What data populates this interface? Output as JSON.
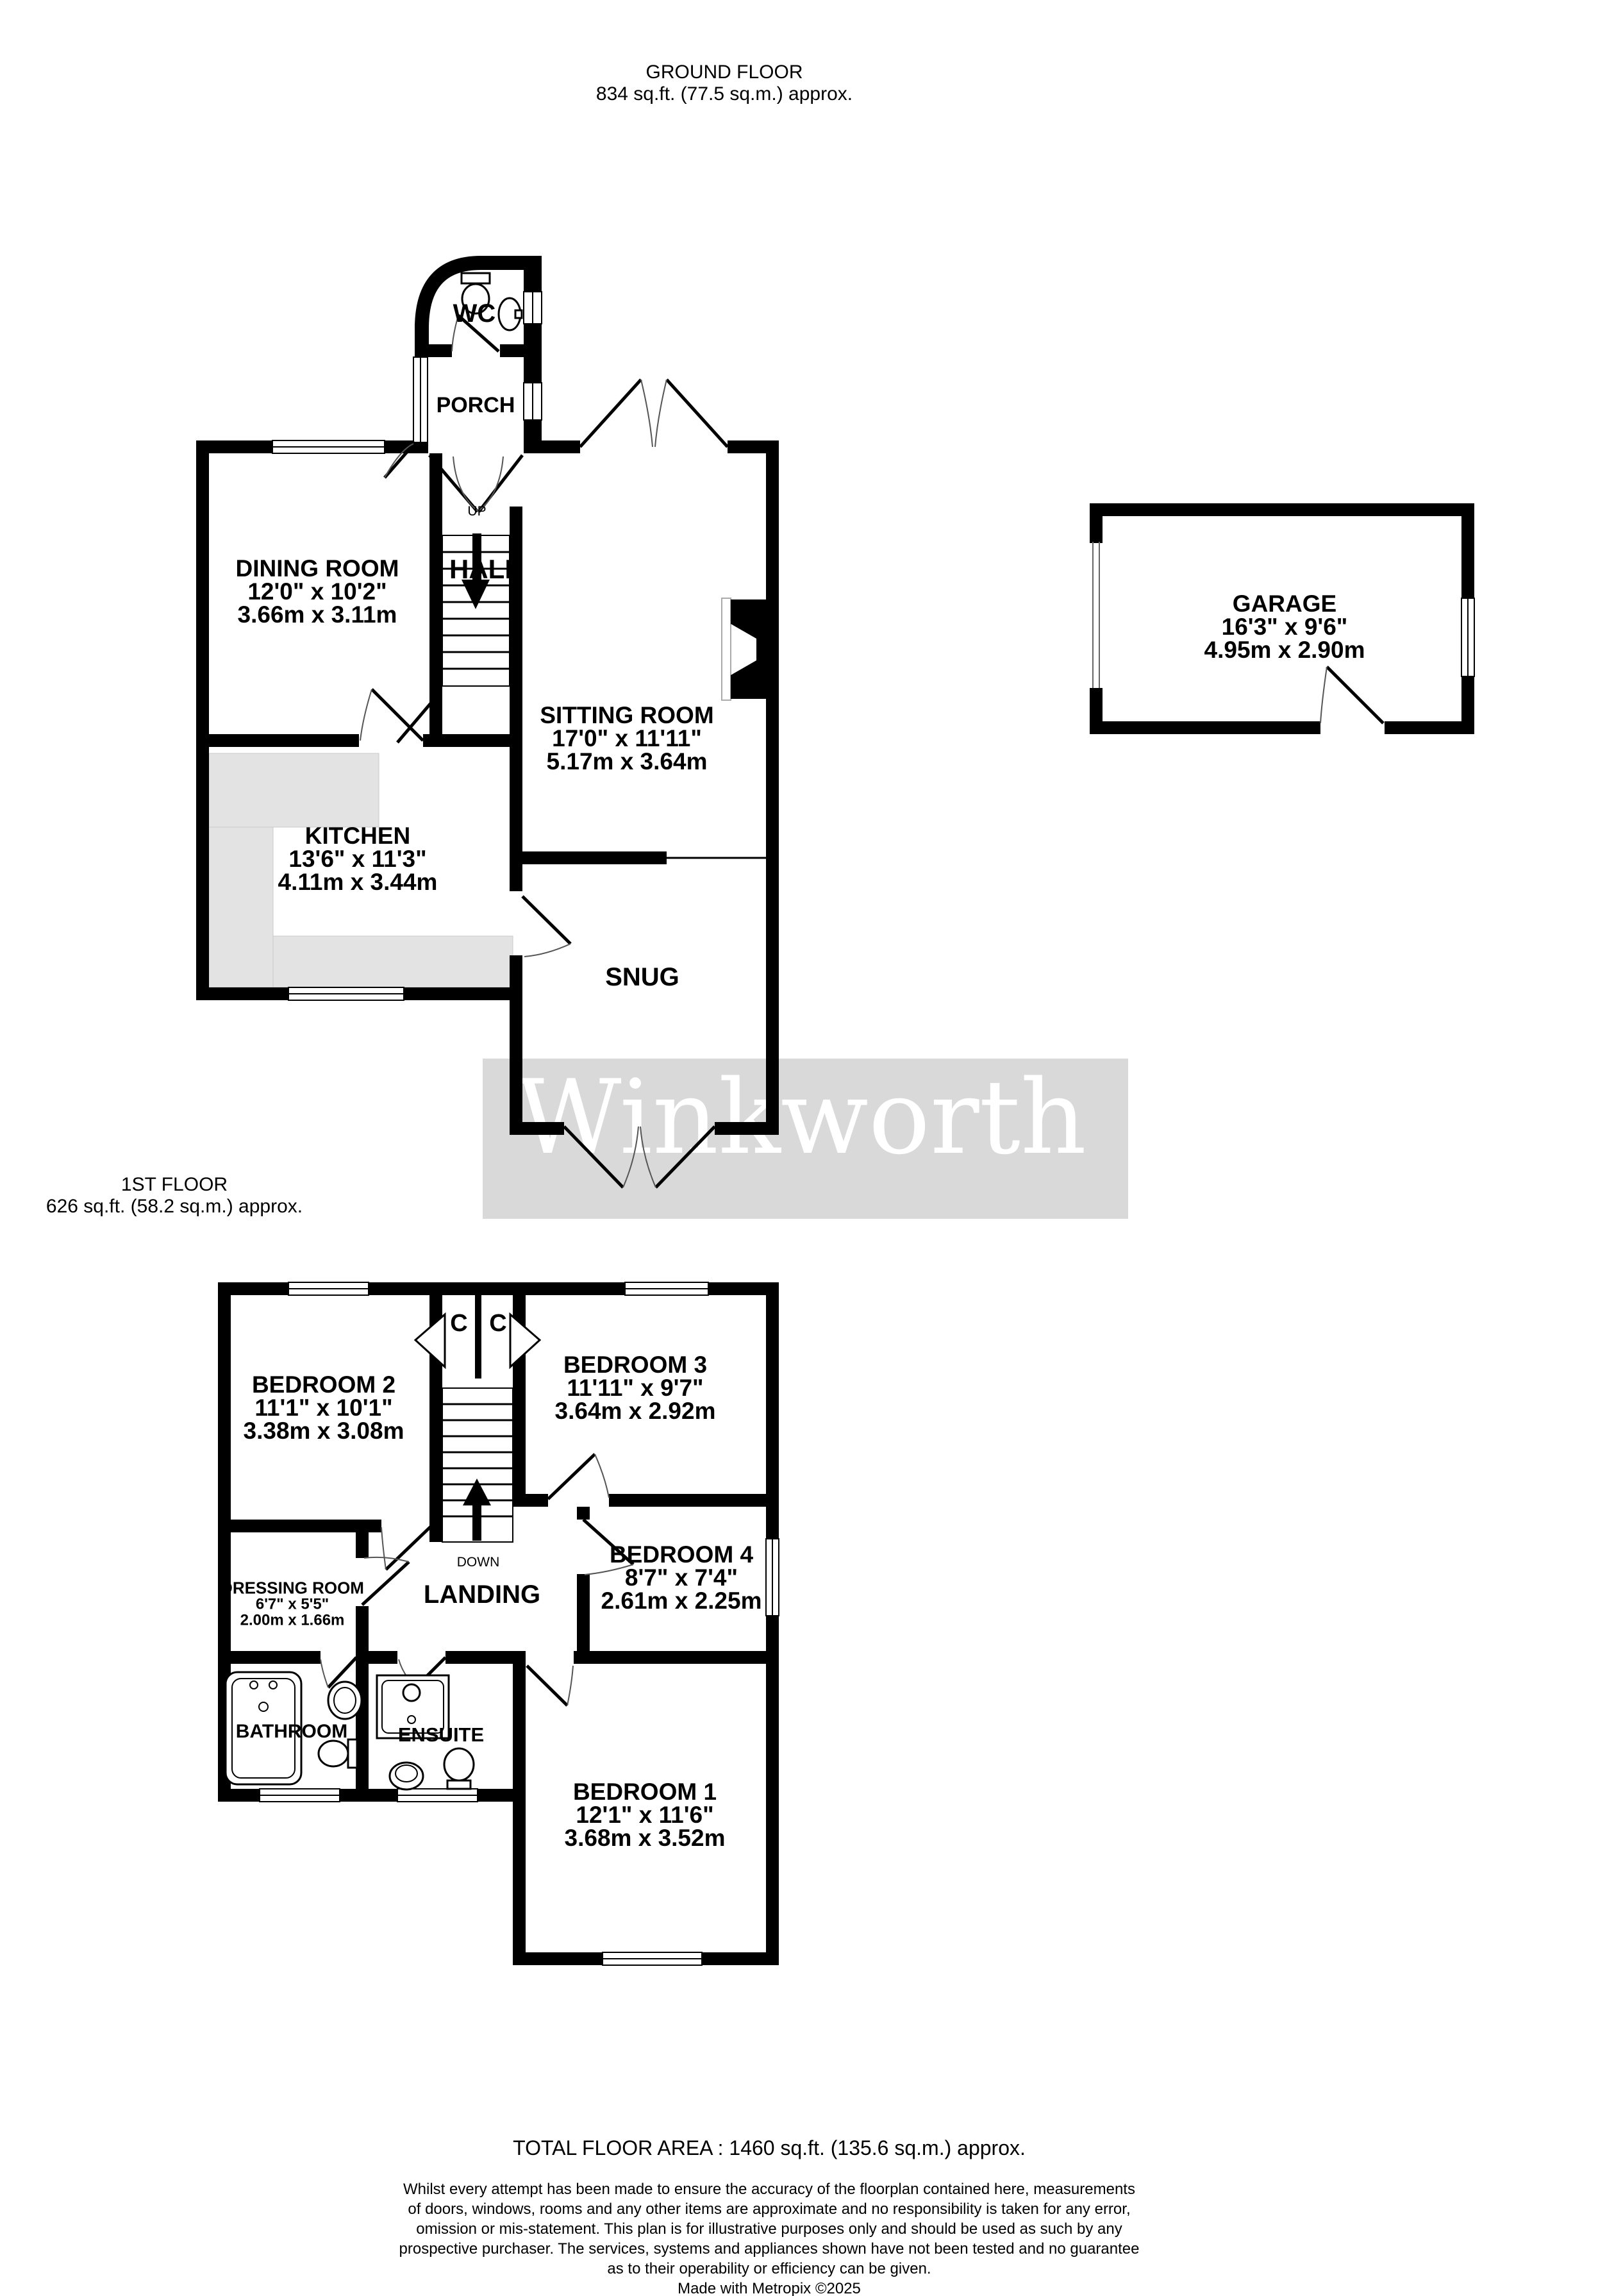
{
  "ground_floor": {
    "title": "GROUND FLOOR",
    "area": "834 sq.ft. (77.5 sq.m.) approx.",
    "rooms": {
      "wc": {
        "name": "WC"
      },
      "porch": {
        "name": "PORCH"
      },
      "hall": {
        "name": "HALL"
      },
      "stairs_up": "UP",
      "dining_room": {
        "name": "DINING ROOM",
        "imperial": "12'0\"  x 10'2\"",
        "metric": "3.66m  x 3.11m"
      },
      "sitting_room": {
        "name": "SITTING ROOM",
        "imperial": "17'0\"  x 11'11\"",
        "metric": "5.17m  x 3.64m"
      },
      "kitchen": {
        "name": "KITCHEN",
        "imperial": "13'6\"  x 11'3\"",
        "metric": "4.11m  x 3.44m"
      },
      "snug": {
        "name": "SNUG"
      },
      "garage": {
        "name": "GARAGE",
        "imperial": "16'3\"  x 9'6\"",
        "metric": "4.95m  x 2.90m"
      }
    }
  },
  "first_floor": {
    "title": "1ST FLOOR",
    "area": "626 sq.ft. (58.2 sq.m.) approx.",
    "rooms": {
      "cupboard_left": "C",
      "cupboard_right": "C",
      "stairs_down": "DOWN",
      "landing": {
        "name": "LANDING"
      },
      "bedroom1": {
        "name": "BEDROOM 1",
        "imperial": "12'1\"  x 11'6\"",
        "metric": "3.68m  x 3.52m"
      },
      "bedroom2": {
        "name": "BEDROOM 2",
        "imperial": "11'1\"  x 10'1\"",
        "metric": "3.38m  x 3.08m"
      },
      "bedroom3": {
        "name": "BEDROOM 3",
        "imperial": "11'11\"  x 9'7\"",
        "metric": "3.64m  x 2.92m"
      },
      "bedroom4": {
        "name": "BEDROOM 4",
        "imperial": "8'7\"  x 7'4\"",
        "metric": "2.61m  x 2.25m"
      },
      "dressing_room": {
        "name": "DRESSING ROOM",
        "imperial": "6'7\"  x 5'5\"",
        "metric": "2.00m  x 1.66m"
      },
      "bathroom": {
        "name": "BATHROOM"
      },
      "ensuite": {
        "name": "ENSUITE"
      }
    }
  },
  "watermark": "Winkworth",
  "footer": {
    "total_area": "TOTAL FLOOR AREA : 1460 sq.ft. (135.6 sq.m.) approx.",
    "disclaimer_lines": [
      "Whilst every attempt has been made to ensure the accuracy of the floorplan contained here, measurements",
      "of doors, windows, rooms and any other items are approximate and no responsibility is taken for any error,",
      "omission or mis-statement. This plan is for illustrative purposes only and should be used as such by any",
      "prospective purchaser. The services, systems and appliances shown have not been tested and no guarantee",
      "as to their operability or efficiency can be given."
    ],
    "credit": "Made with Metropix ©2025"
  },
  "colors": {
    "wall": "#000000",
    "counter": "#e3e3e3",
    "watermark_band": "#d9d9d9",
    "watermark_text": "#ffffff"
  }
}
